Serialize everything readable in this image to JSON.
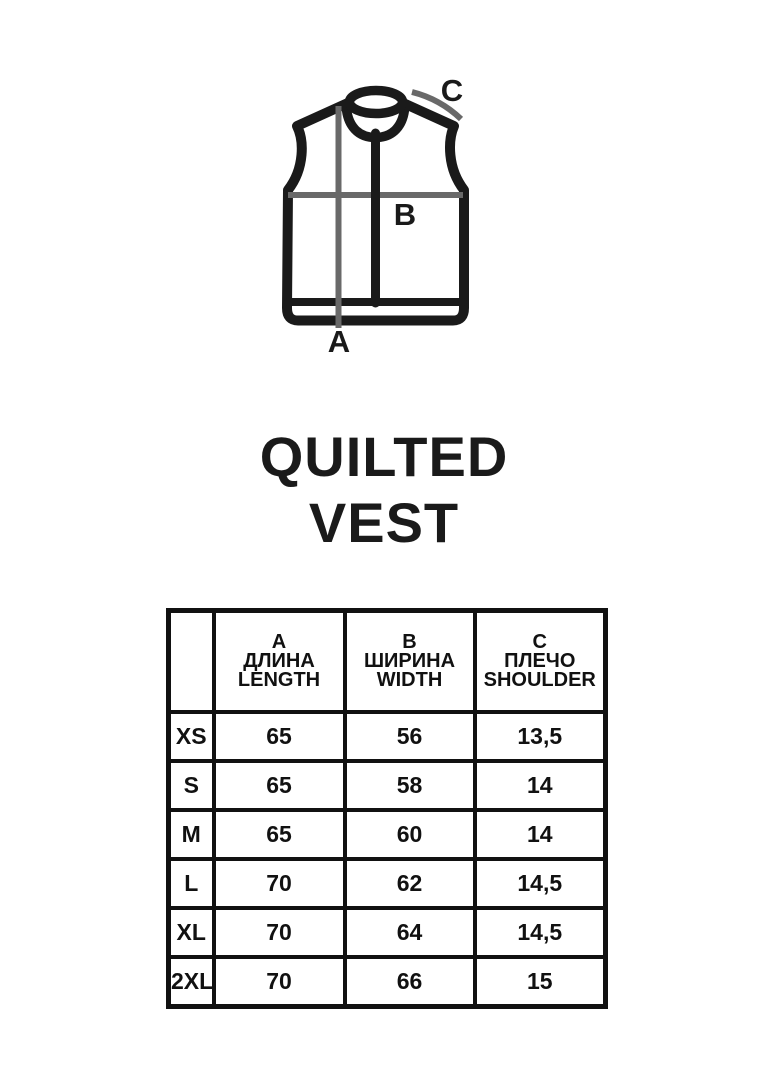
{
  "colors": {
    "ink": "#1a1a1a",
    "measure": "#696969",
    "table_ink": "#111111",
    "background": "#ffffff"
  },
  "diagram": {
    "labels": {
      "a": "A",
      "b": "B",
      "c": "C"
    }
  },
  "title": {
    "line1": "QUILTED",
    "line2": "VEST"
  },
  "size_table": {
    "corner": "",
    "columns": [
      {
        "letter": "A",
        "ru": "ДЛИНА",
        "en": "LENGTH"
      },
      {
        "letter": "B",
        "ru": "ШИРИНА",
        "en": "WIDTH"
      },
      {
        "letter": "C",
        "ru": "ПЛЕЧО",
        "en": "SHOULDER"
      }
    ],
    "rows": [
      {
        "size": "XS",
        "length": "65",
        "width": "56",
        "shoulder": "13,5"
      },
      {
        "size": "S",
        "length": "65",
        "width": "58",
        "shoulder": "14"
      },
      {
        "size": "M",
        "length": "65",
        "width": "60",
        "shoulder": "14"
      },
      {
        "size": "L",
        "length": "70",
        "width": "62",
        "shoulder": "14,5"
      },
      {
        "size": "XL",
        "length": "70",
        "width": "64",
        "shoulder": "14,5"
      },
      {
        "size": "2XL",
        "length": "70",
        "width": "66",
        "shoulder": "15"
      }
    ]
  }
}
